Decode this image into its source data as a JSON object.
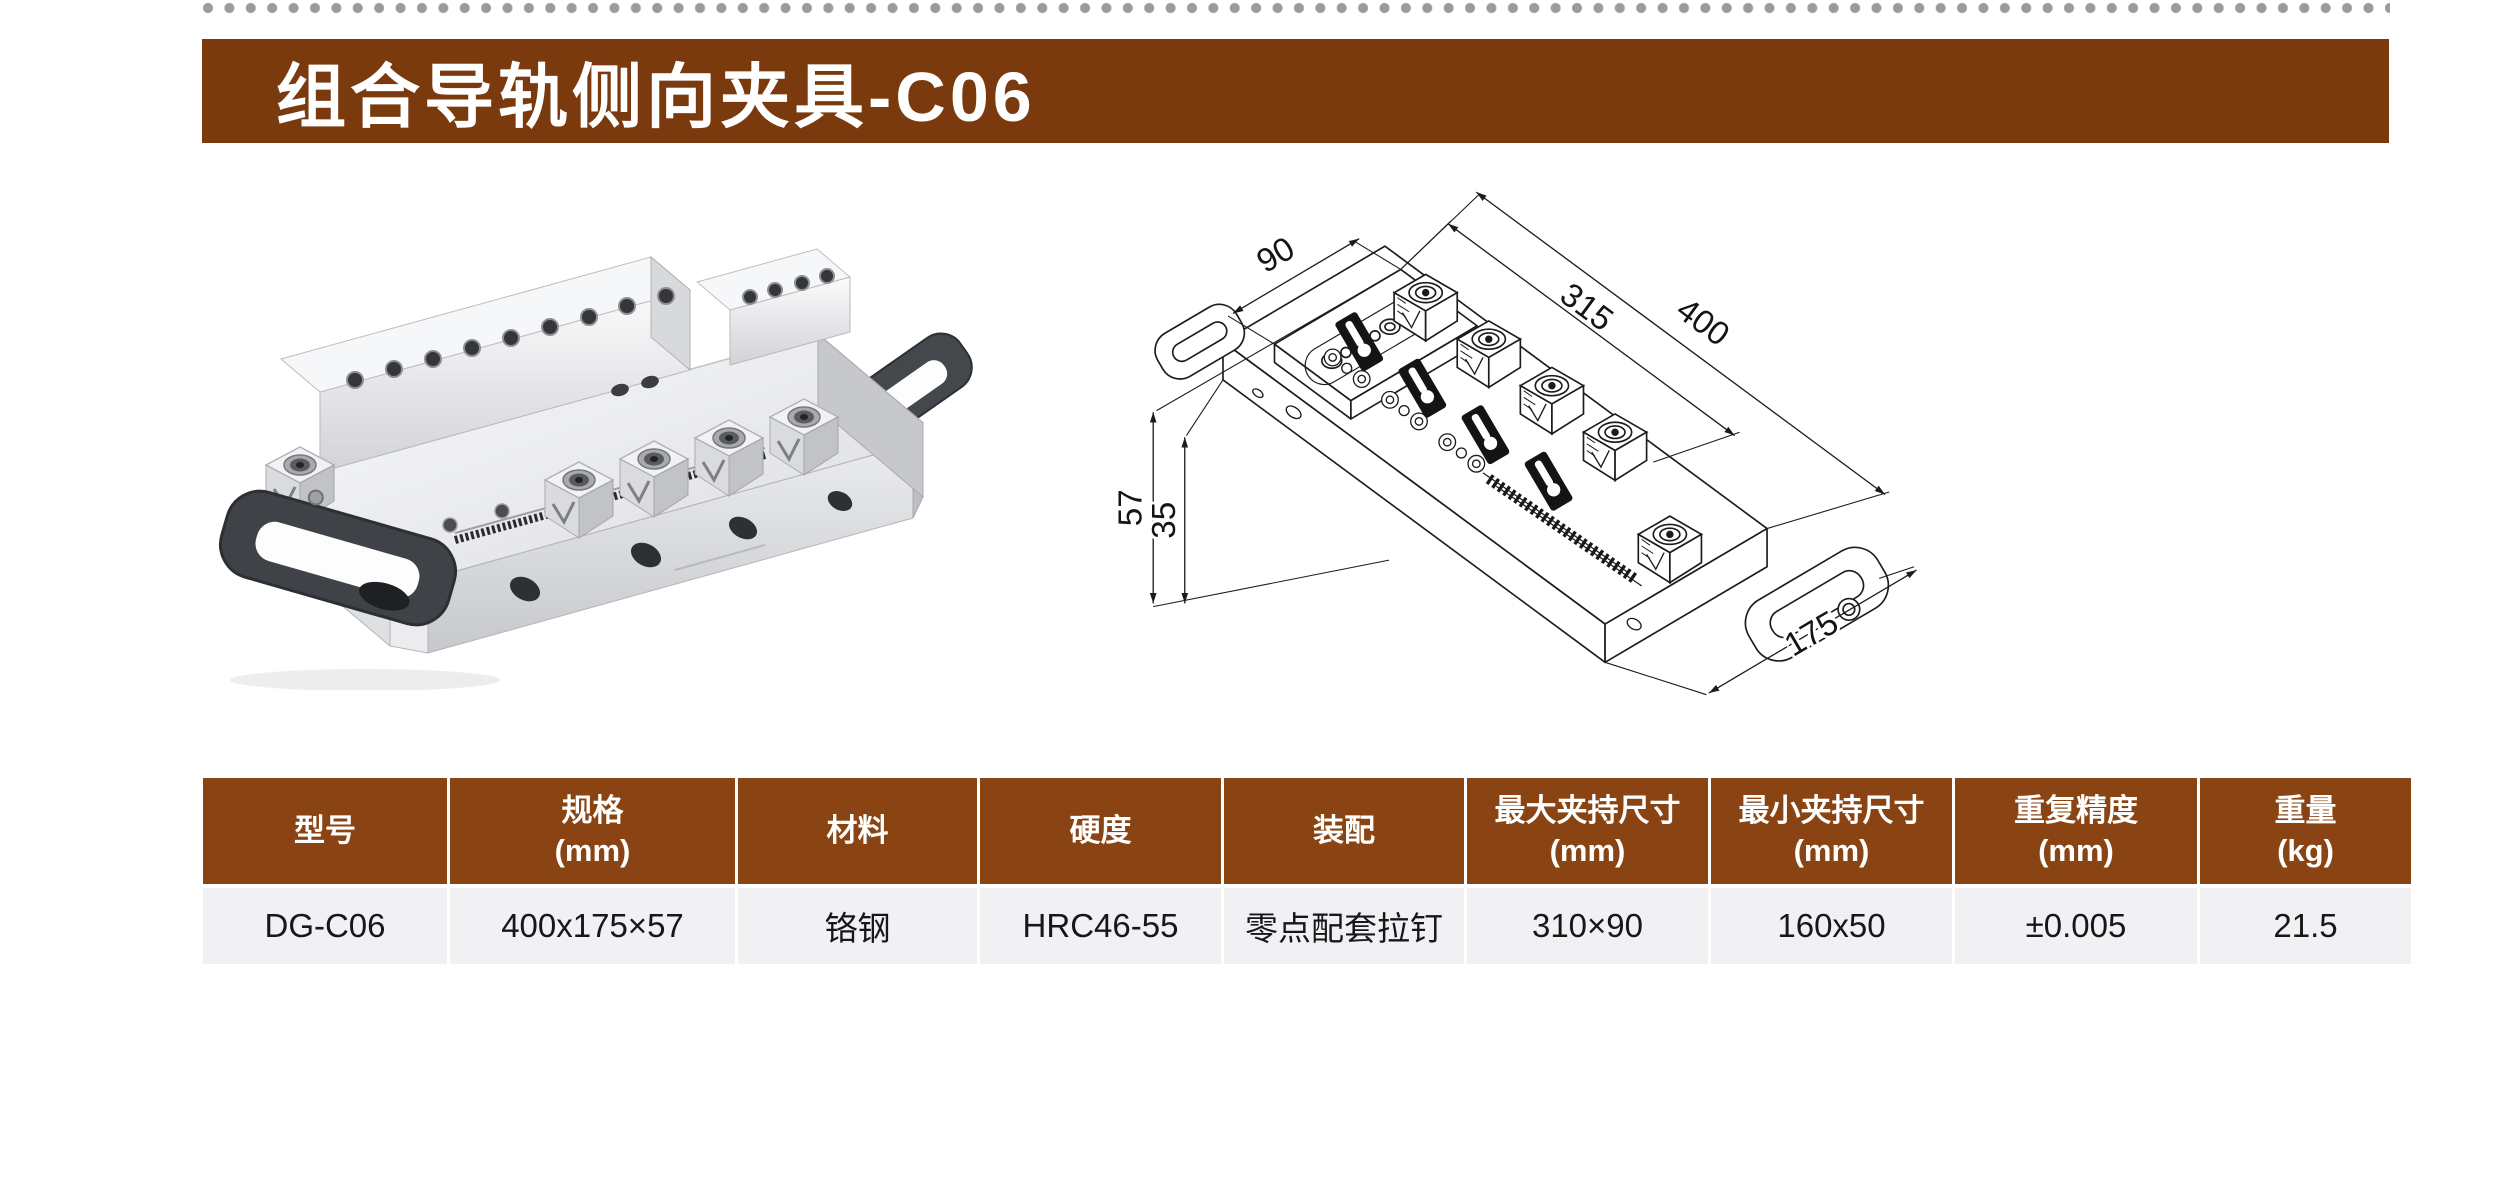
{
  "title": {
    "text": "组合导轨侧向夹具-C06"
  },
  "decor": {
    "dot_color": "#9b9b9b"
  },
  "colors": {
    "title_bar": "#7a3a0d",
    "table_header_bg": "#8a4413",
    "table_row_bg": "#f1f1f3",
    "drawing_line": "#1c1c1c"
  },
  "drawing": {
    "dims": {
      "block_width": "90",
      "clamp_span": "315",
      "total_length": "400",
      "total_height": "57",
      "base_height": "35",
      "end_width": "175"
    }
  },
  "table": {
    "columns": [
      {
        "label": "型号",
        "unit": ""
      },
      {
        "label": "规格",
        "unit": "(mm)"
      },
      {
        "label": "材料",
        "unit": ""
      },
      {
        "label": "硬度",
        "unit": ""
      },
      {
        "label": "装配",
        "unit": ""
      },
      {
        "label": "最大夹持尺寸",
        "unit": "(mm)"
      },
      {
        "label": "最小夹持尺寸",
        "unit": "(mm)"
      },
      {
        "label": "重复精度",
        "unit": "(mm)"
      },
      {
        "label": "重量",
        "unit": "(kg)"
      }
    ],
    "row": [
      "DG-C06",
      "400x175×57",
      "铬钢",
      "HRC46-55",
      "零点配套拉钉",
      "310×90",
      "160x50",
      "±0.005",
      "21.5"
    ]
  }
}
